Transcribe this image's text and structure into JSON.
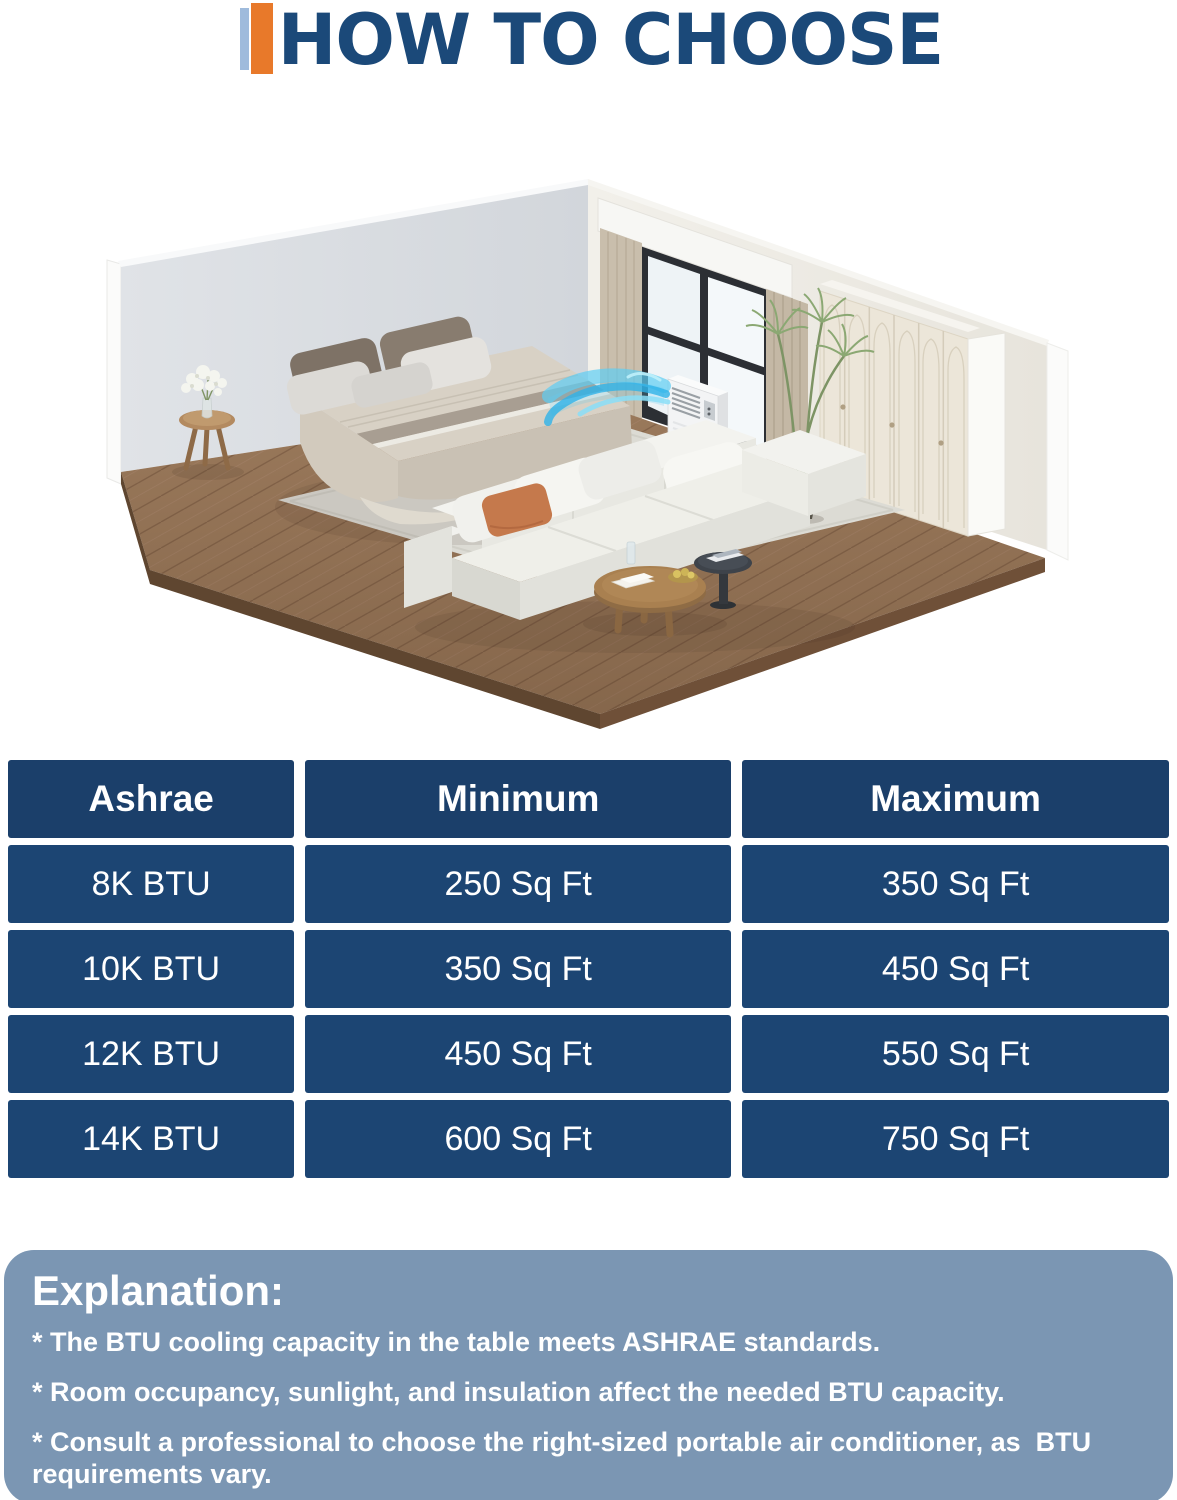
{
  "title": {
    "text": "HOW TO CHOOSE"
  },
  "accent": {
    "navy": "#1B4979",
    "orange": "#E8792A",
    "light_blue": "#9FBBDC"
  },
  "illustration": {
    "description": "Isometric cutaway bedroom: a portable air conditioner stands by the window and blows cool air toward the bed",
    "objects": [
      "left-wall",
      "right-wall",
      "window",
      "valance",
      "curtains",
      "wardrobe",
      "herringbone-wood-floor",
      "area-rug",
      "double-bed",
      "pillows",
      "side-table",
      "flower-vase",
      "portable-air-conditioner",
      "cool-airflow",
      "potted-plant",
      "modular-sofa",
      "terracotta-pillow",
      "round-coffee-table",
      "accent-side-table"
    ]
  },
  "table": {
    "columns": [
      "Ashrae",
      "Minimum",
      "Maximum"
    ],
    "rows": [
      [
        "8K BTU",
        "250 Sq Ft",
        "350 Sq Ft"
      ],
      [
        "10K BTU",
        "350 Sq Ft",
        "450 Sq Ft"
      ],
      [
        "12K BTU",
        "450 Sq Ft",
        "550 Sq Ft"
      ],
      [
        "14K BTU",
        "600 Sq Ft",
        "750 Sq Ft"
      ]
    ],
    "colors": {
      "header_bg": "#1B3F6A",
      "row_bg": "#1C4573",
      "text": "#FFFFFF"
    }
  },
  "explanation": {
    "heading": "Explanation:",
    "bullets": [
      "* The BTU cooling capacity in the table meets ASHRAE standards.",
      "* Room occupancy, sunlight, and insulation affect the needed BTU capacity.",
      "* Consult a professional to choose the right-sized portable air conditioner, as  BTU requirements vary."
    ],
    "background": "#7B96B3",
    "text_color": "#FFFFFF"
  }
}
